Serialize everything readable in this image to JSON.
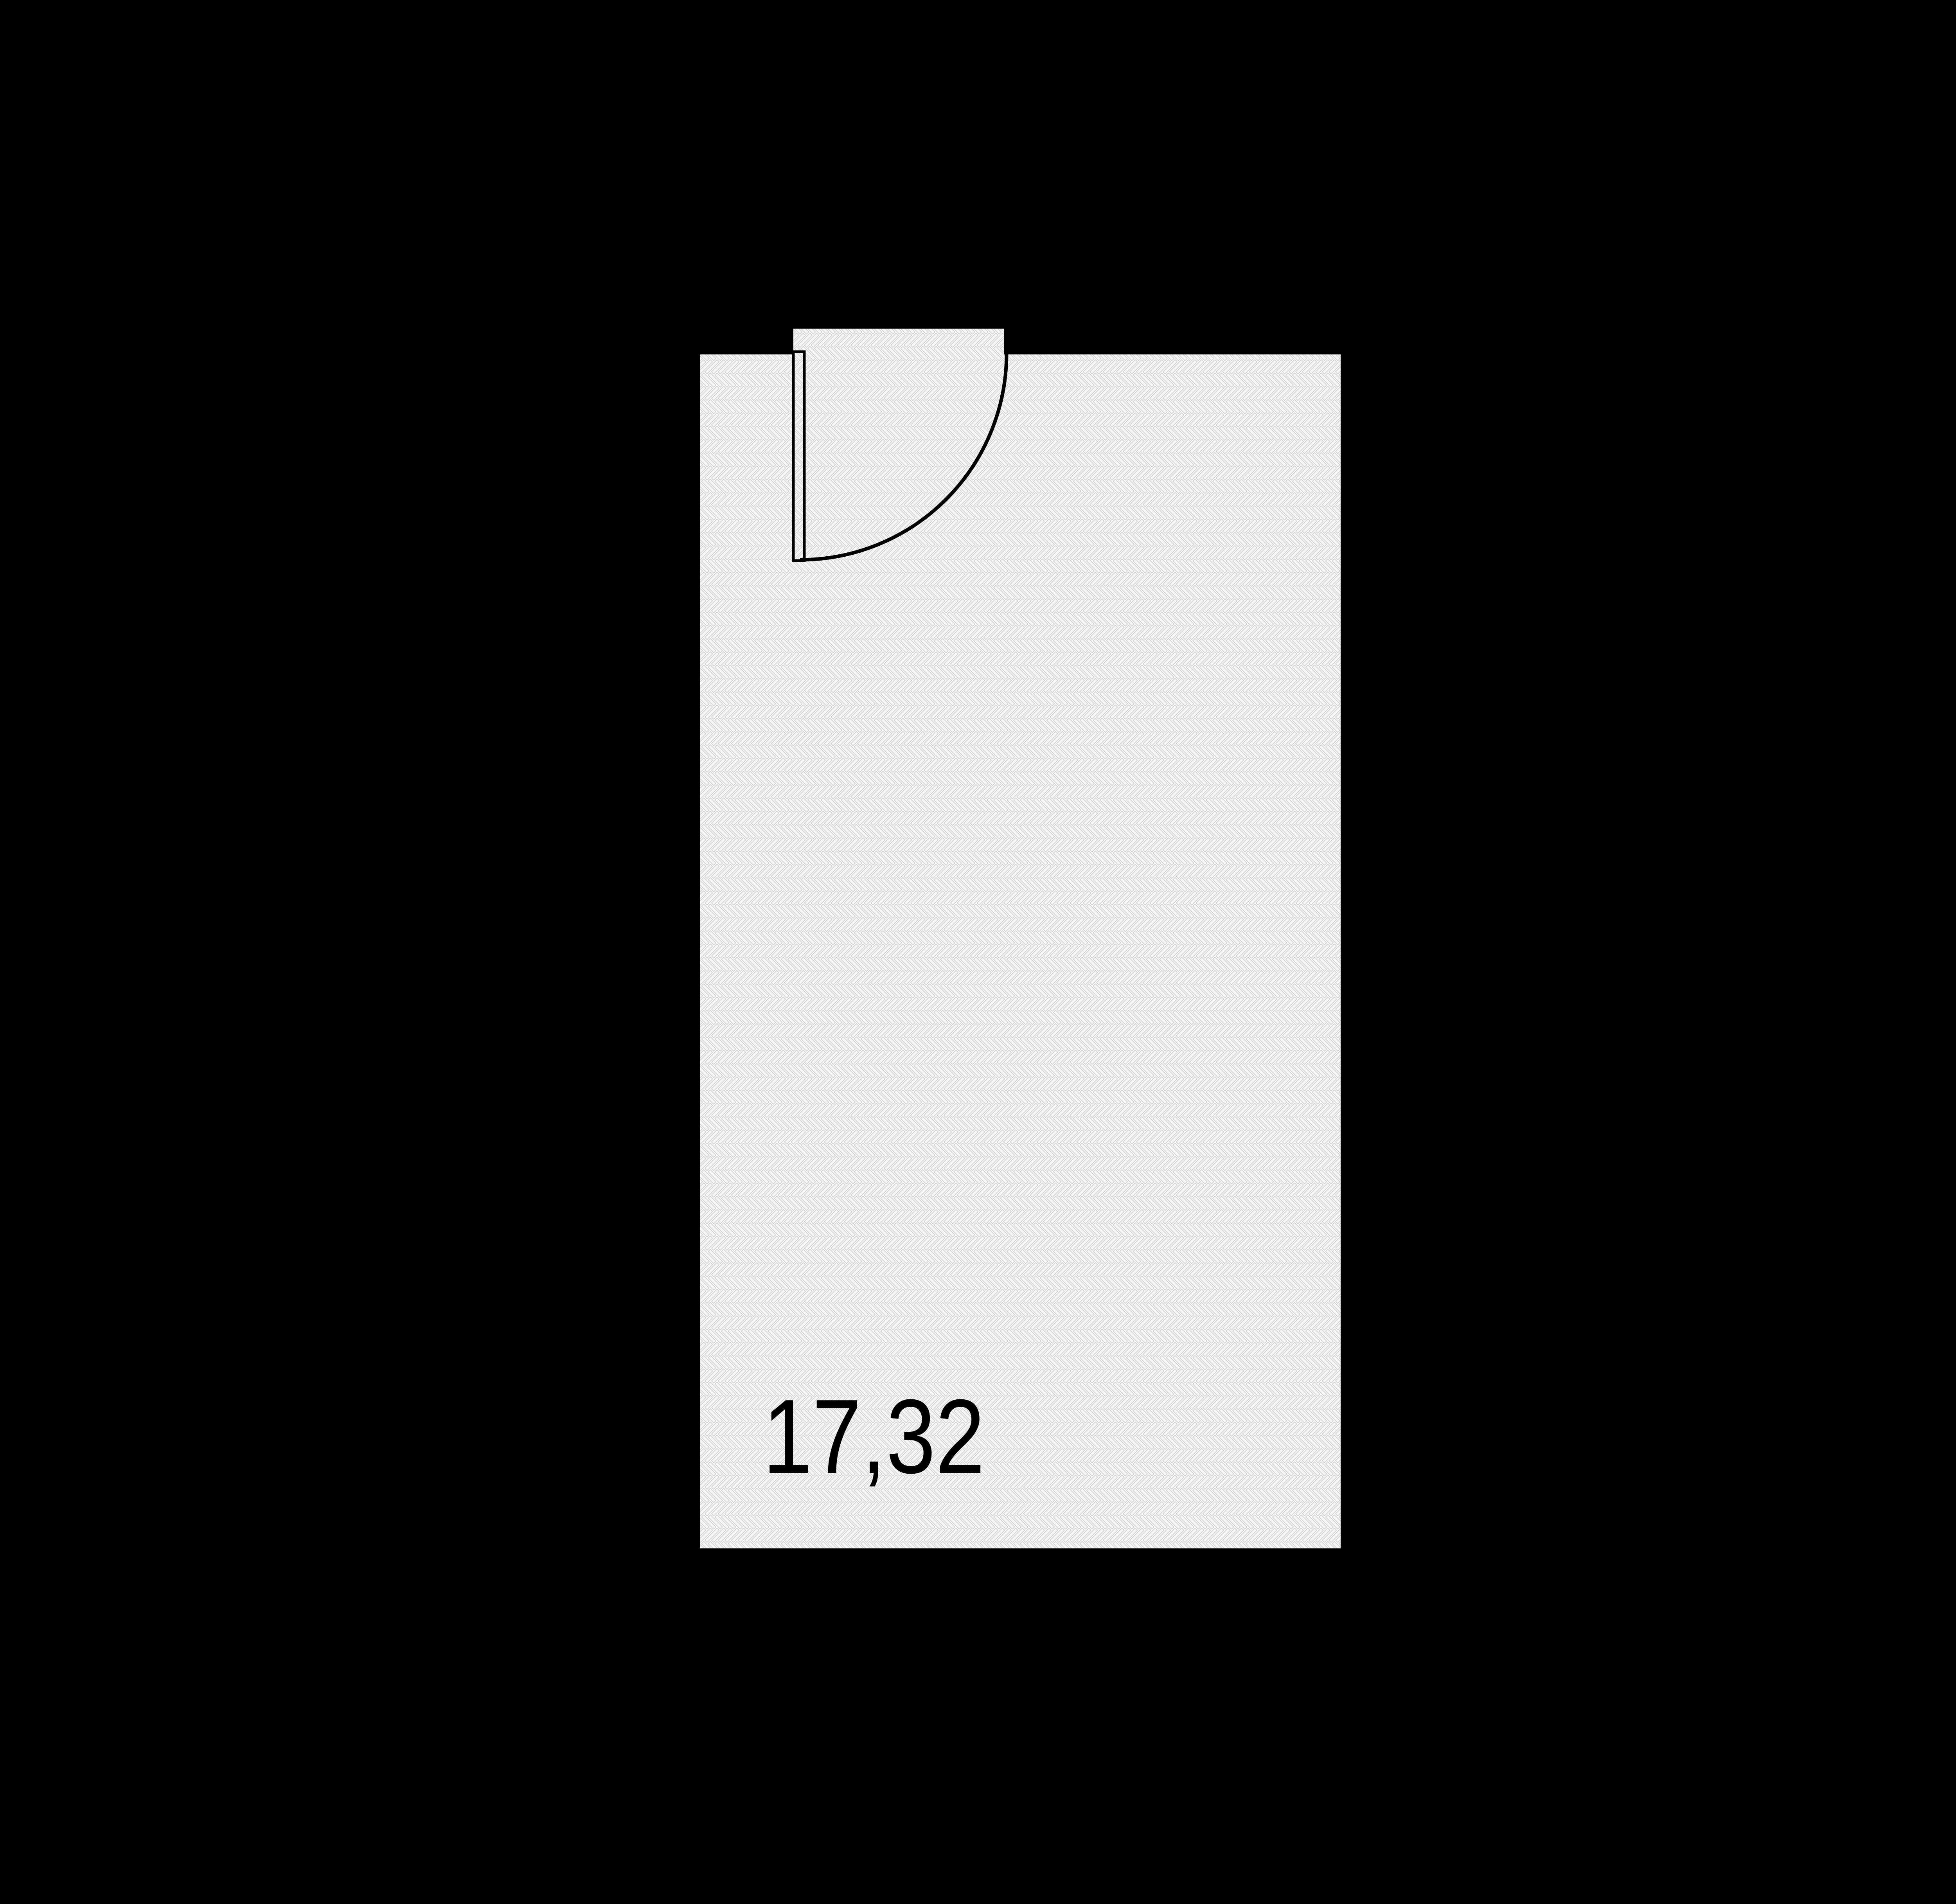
{
  "page": {
    "kind": "floor-plan",
    "background_color": "#000000"
  },
  "room": {
    "area_label": "17,32",
    "floor_texture": "herringbone-parquet",
    "features": {
      "door": "single-leaf-door-with-90-degree-swing-arc",
      "doorway_recess": "floor-extends-into-door-opening-at-top-wall"
    },
    "colors": {
      "floor_seam_base": "#ffffff",
      "plank_fill": "#f6f6f6",
      "plank_line": "#c9c9c9",
      "door_outline": "#000000",
      "label_color": "#000000"
    }
  }
}
